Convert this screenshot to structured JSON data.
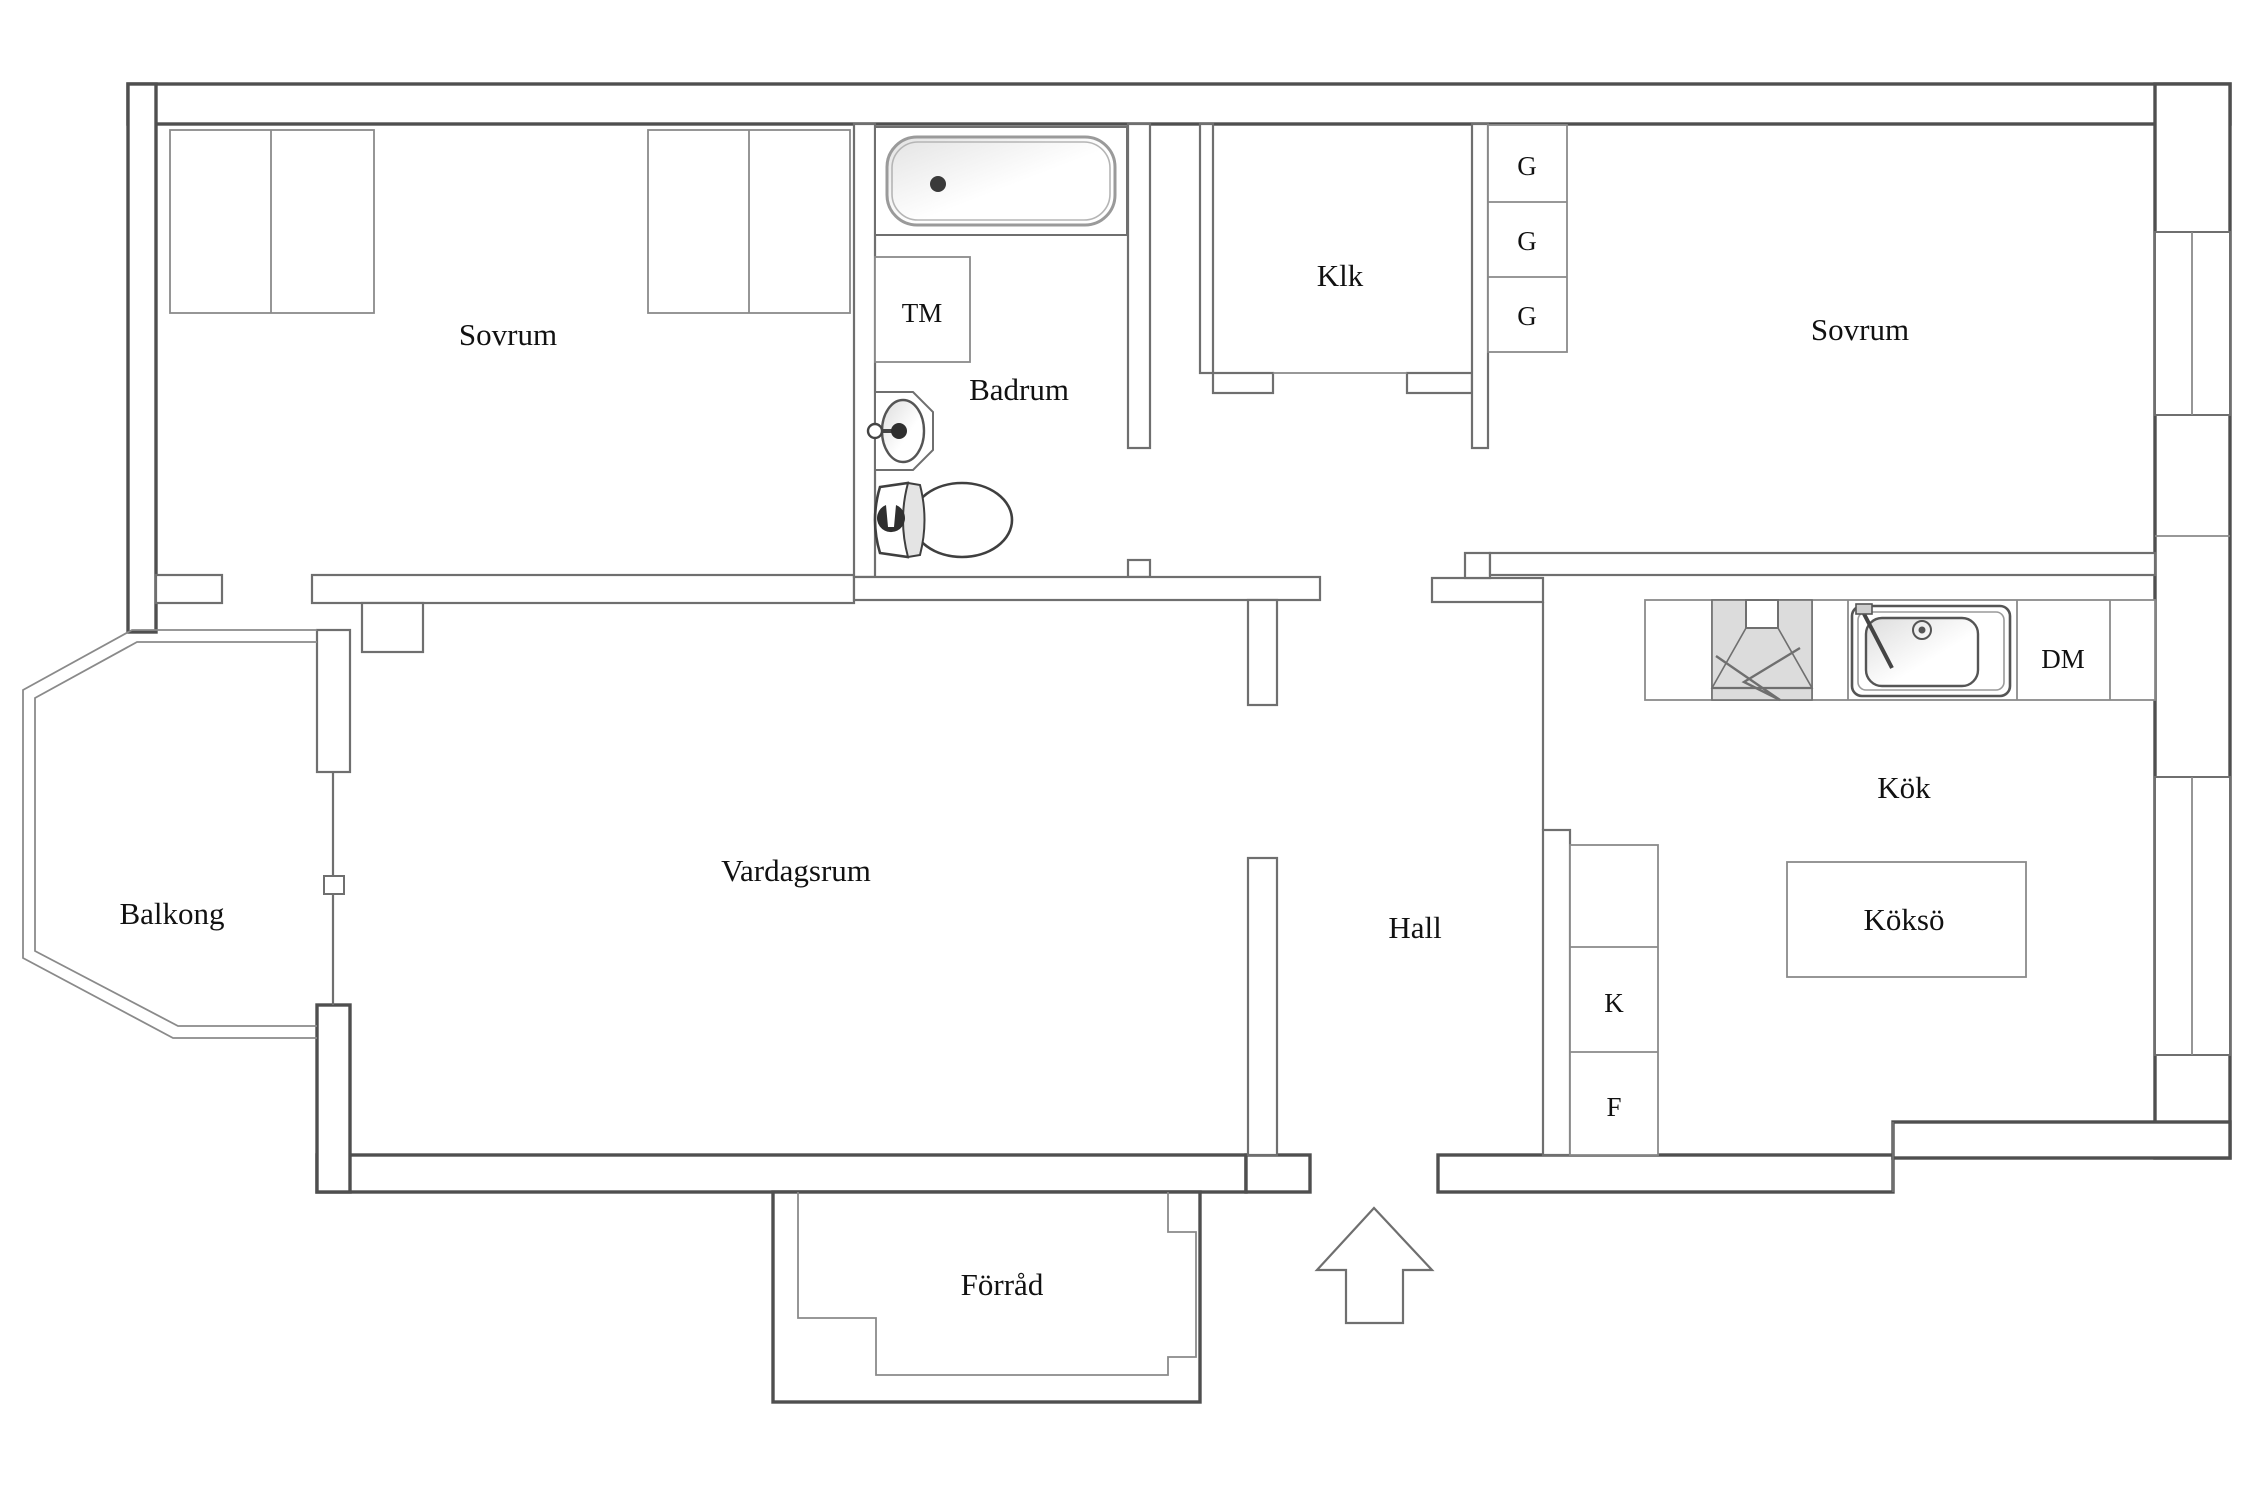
{
  "plan": {
    "title": "Apartment floor plan",
    "rooms": [
      {
        "id": "sovrum-1",
        "label": "Sovrum"
      },
      {
        "id": "sovrum-2",
        "label": "Sovrum"
      },
      {
        "id": "badrum",
        "label": "Badrum"
      },
      {
        "id": "klk",
        "label": "Klk"
      },
      {
        "id": "kok",
        "label": "Kök"
      },
      {
        "id": "kokso",
        "label": "Köksö"
      },
      {
        "id": "hall",
        "label": "Hall"
      },
      {
        "id": "vardagsrum",
        "label": "Vardagsrum"
      },
      {
        "id": "balkong",
        "label": "Balkong"
      },
      {
        "id": "forrad",
        "label": "Förråd"
      }
    ],
    "fixtures": [
      {
        "id": "tm",
        "label": "TM"
      },
      {
        "id": "dm",
        "label": "DM"
      },
      {
        "id": "k",
        "label": "K"
      },
      {
        "id": "f",
        "label": "F"
      },
      {
        "id": "g1",
        "label": "G"
      },
      {
        "id": "g2",
        "label": "G"
      },
      {
        "id": "g3",
        "label": "G"
      }
    ],
    "icons": {
      "entrance": "arrow-up",
      "bath": "bathtub",
      "wc": "toilet",
      "basin": "washbasin",
      "kitchen_sink": "sink",
      "cooker": "stove-hood"
    },
    "colors": {
      "wall_line": "#6f6f6f",
      "outer_line": "#4f4f4f",
      "thin_line": "#8a8a8a",
      "fixture_fill": "#efefef",
      "shade_fill": "#dcdcdc",
      "text": "#111111",
      "background": "#ffffff"
    }
  }
}
